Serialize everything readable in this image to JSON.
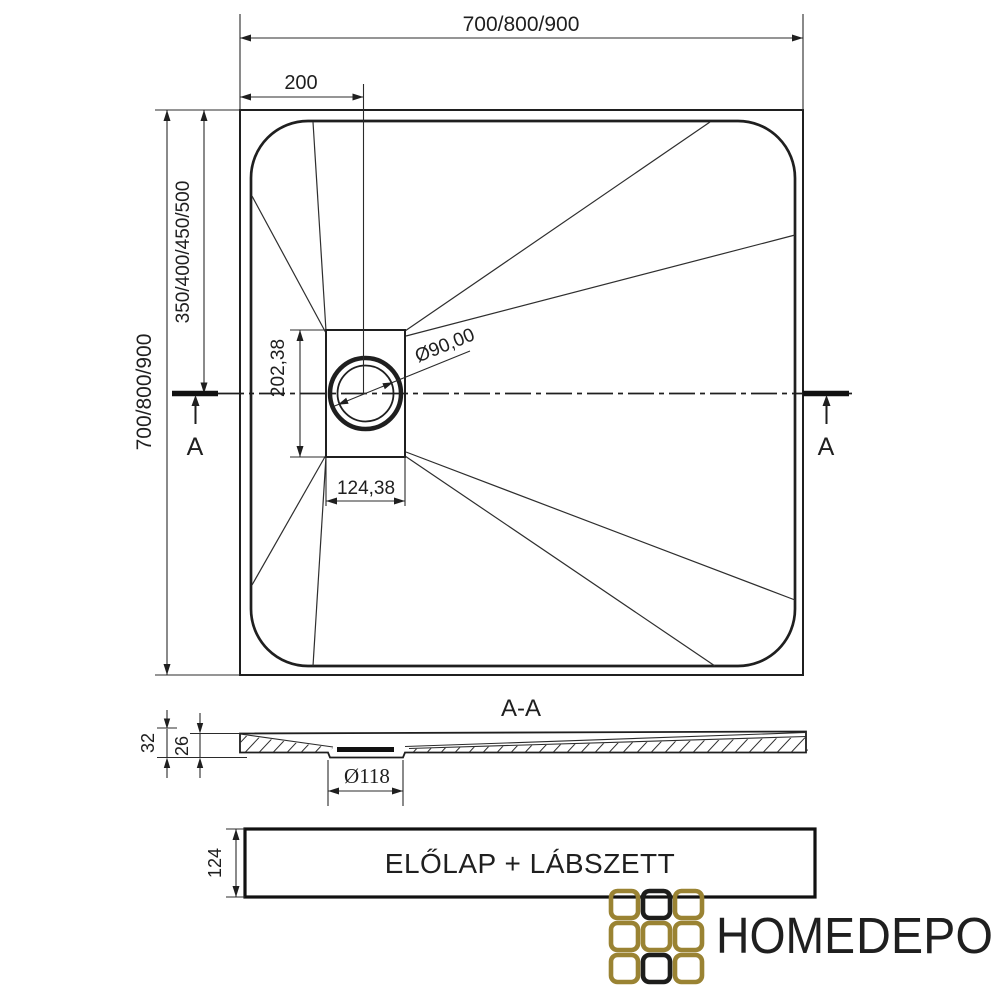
{
  "top_view": {
    "width_dim": "700/800/900",
    "offset_dim": "200",
    "height_dim": "700/800/900",
    "center_dim": "350/400/450/500",
    "drain_height_dim": "202,38",
    "drain_width_dim": "124,38",
    "drain_diameter": "Ø90,00",
    "section_marker_left": "A",
    "section_marker_right": "A"
  },
  "section_view": {
    "title": "A-A",
    "total_height_dim": "32",
    "inner_height_dim": "26",
    "drain_diameter": "Ø118"
  },
  "panel": {
    "label": "ELŐLAP + LÁBSZETT",
    "height_dim": "124"
  },
  "logo": {
    "text_primary": "HOME",
    "text_secondary": "DEPO",
    "gold": "#9a8333",
    "dark": "#1d1d1b",
    "grid": [
      "gold",
      "dark",
      "gold",
      "gold",
      "gold",
      "gold",
      "gold",
      "dark",
      "gold"
    ]
  },
  "colors": {
    "line": "#1f1f1f",
    "background": "#ffffff"
  }
}
